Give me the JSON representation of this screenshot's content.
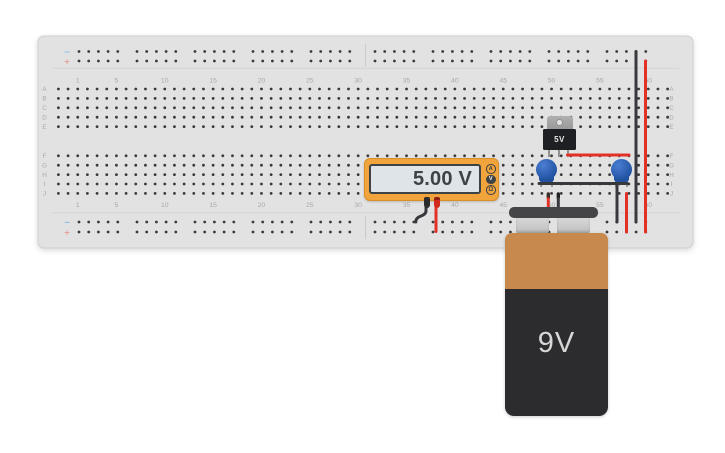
{
  "board": {
    "row_labels_top": [
      "A",
      "B",
      "C",
      "D",
      "E"
    ],
    "row_labels_bottom": [
      "F",
      "G",
      "H",
      "I",
      "J"
    ],
    "column_label_values": [
      1,
      5,
      10,
      15,
      20,
      25,
      30,
      35,
      40,
      45,
      50,
      55,
      60
    ],
    "rail_minus_label": "−",
    "rail_plus_label": "+"
  },
  "multimeter": {
    "display_value": "5.00 V",
    "mode_buttons": [
      {
        "label": "A",
        "selected": false
      },
      {
        "label": "V",
        "selected": true
      },
      {
        "label": "Ω",
        "selected": false
      }
    ]
  },
  "regulator": {
    "label": "5V"
  },
  "battery": {
    "label": "9V"
  },
  "colors": {
    "board-bg": "#e2e2e3",
    "board-edge": "#d0d0d1",
    "hole": "#3a3a3a",
    "label": "#a8a8a8",
    "rail-minus": "#93bcd9",
    "rail-plus": "#e5a29a",
    "meter-body": "#f1a43c",
    "meter-display-bg": "#dee4e7",
    "meter-dark": "#3d4247",
    "wire-red": "#e23227",
    "wire-black": "#38393c",
    "cap-blue-light": "#4a7ed2",
    "cap-blue-dark": "#20509f",
    "regulator-body": "#1f2023",
    "battery-orange": "#c8894c",
    "battery-dark": "#2c2c2f",
    "battery-text": "#d6d6d6"
  }
}
